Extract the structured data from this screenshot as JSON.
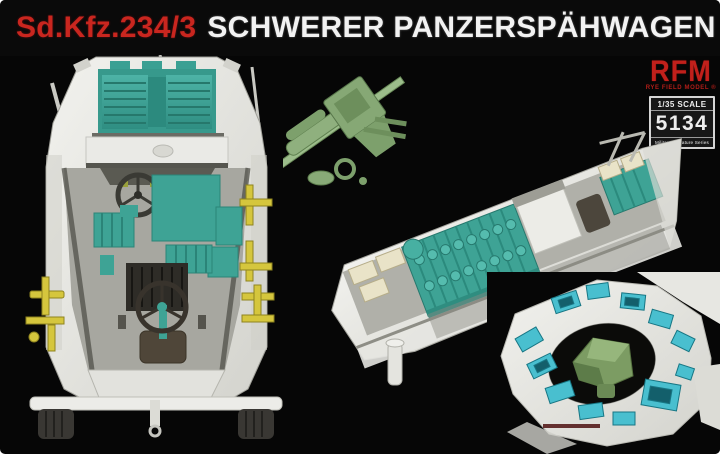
{
  "title": {
    "kit_code": "Sd.Kfz.234/3",
    "kit_name": "SCHWERER PANZERSPÄHWAGEN"
  },
  "brand": {
    "logo": "RFM",
    "subtitle": "RYE FIELD MODEL ®"
  },
  "badge": {
    "scale": "1/35 SCALE",
    "number": "5134",
    "series": "Military Miniature Series"
  },
  "colors": {
    "title_red": "#c9261f",
    "brand_red": "#c1201b",
    "background": "#060606",
    "hull_white": "#e9e9e4",
    "interior_teal": "#3ea395",
    "inset_cyan": "#49bfcf",
    "gun_green": "#86a875",
    "tool_yellow": "#d5c63d",
    "seat_brown": "#4f4639"
  }
}
